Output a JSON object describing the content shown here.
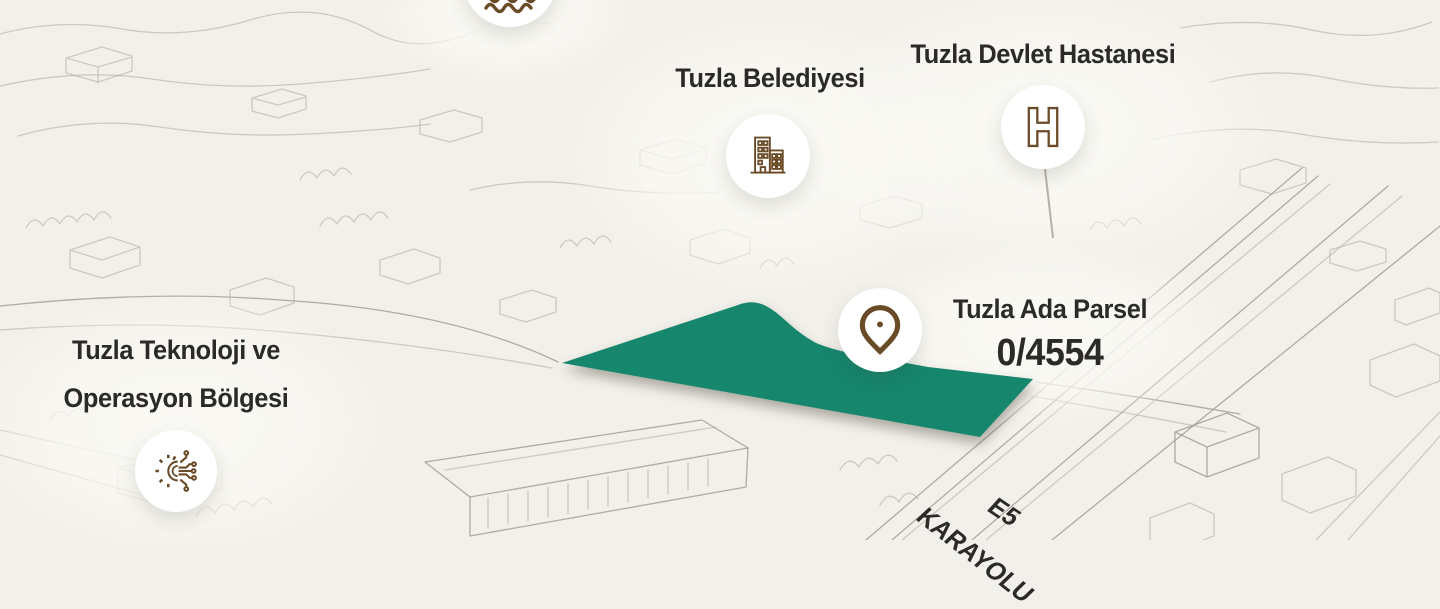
{
  "theme": {
    "bg": "#f2f0ea",
    "sketch": "#b4b1a6",
    "sketch-dark": "#9d9a90",
    "teal": "#16866D",
    "brown": "#6a4b28",
    "brown-dark": "#564022",
    "ink": "#2b2a27",
    "circle-bg": "#ffffff"
  },
  "markers": {
    "top_partial": {
      "icon": "waves-icon"
    },
    "belediye": {
      "label": "Tuzla Belediyesi",
      "icon": "building-icon"
    },
    "hastane": {
      "label": "Tuzla Devlet Hastanesi",
      "icon": "hospital-h-icon"
    },
    "parsel": {
      "label": "Tuzla Ada Parsel",
      "value": "0/4554",
      "icon": "map-pin-icon"
    },
    "teknoloji": {
      "label_line1": "Tuzla Teknoloji ve",
      "label_line2": "Operasyon Bölgesi",
      "icon": "gear-circuit-icon"
    }
  },
  "road_labels": {
    "name": "E5",
    "type": "KARAYOLU"
  }
}
